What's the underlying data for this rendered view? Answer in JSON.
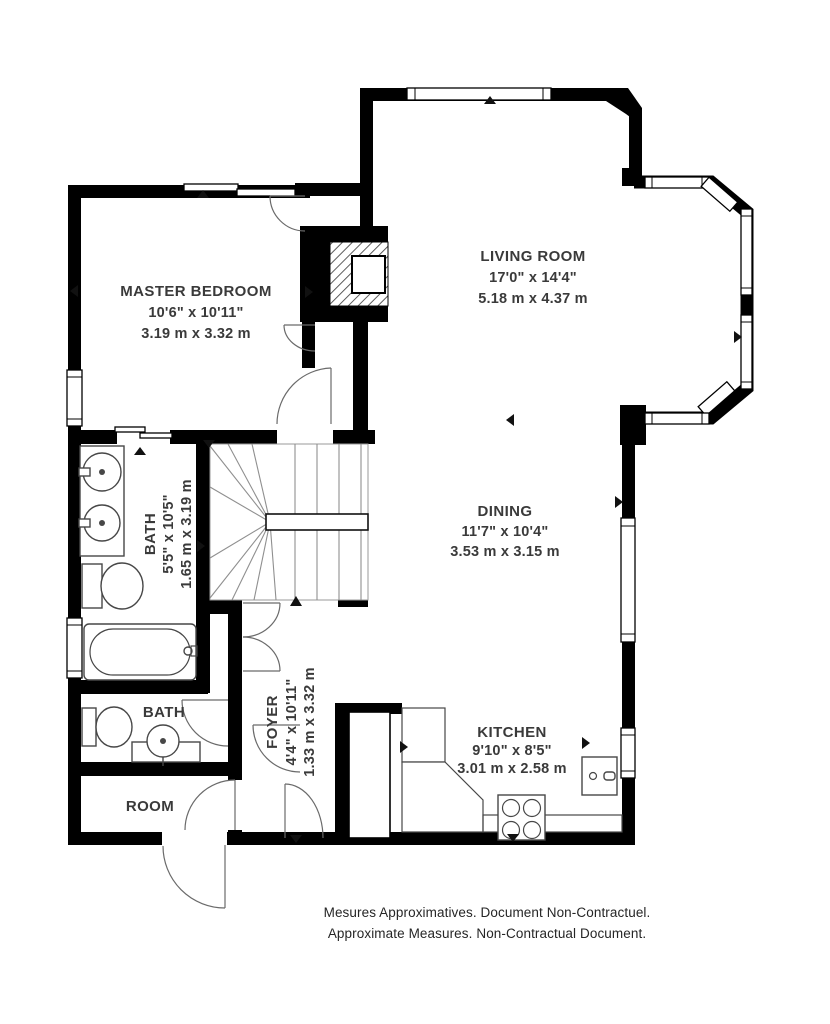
{
  "plan": {
    "rooms": [
      {
        "id": "master-bedroom",
        "name": "MASTER BEDROOM",
        "imperial": "10'6\" x 10'11\"",
        "metric": "3.19 m x 3.32 m"
      },
      {
        "id": "living-room",
        "name": "LIVING ROOM",
        "imperial": "17'0\" x 14'4\"",
        "metric": "5.18 m x 4.37 m"
      },
      {
        "id": "dining",
        "name": "DINING",
        "imperial": "11'7\" x 10'4\"",
        "metric": "3.53 m x 3.15 m"
      },
      {
        "id": "kitchen",
        "name": "KITCHEN",
        "imperial": "9'10\" x 8'5\"",
        "metric": "3.01 m x 2.58 m"
      },
      {
        "id": "bath",
        "name": "BATH",
        "imperial": "5'5\" x 10'5\"",
        "metric": "1.65 m x 3.19 m"
      },
      {
        "id": "foyer",
        "name": "FOYER",
        "imperial": "4'4\" x 10'11\"",
        "metric": "1.33 m x 3.32 m"
      },
      {
        "id": "bath-2",
        "name": "BATH"
      },
      {
        "id": "room",
        "name": "ROOM"
      }
    ],
    "footer": {
      "line1": "Mesures Approximatives. Document Non-Contractuel.",
      "line2": "Approximate Measures. Non-Contractual Document."
    },
    "colors": {
      "wall": "#000000",
      "fixture": "#474747",
      "label": "#3a3a3a"
    }
  }
}
